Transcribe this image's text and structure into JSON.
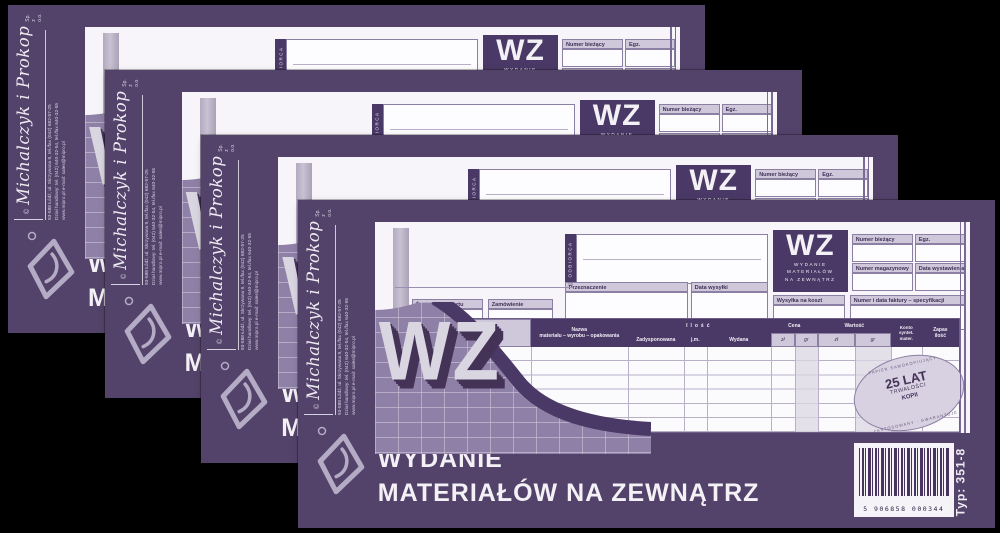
{
  "canvas": {
    "background": "#000000"
  },
  "copies": 4,
  "colors": {
    "purple": "#53426a",
    "purple_dark": "#4a3866",
    "strip_light": "#cfc8da",
    "paper": "#f7f5f9",
    "checker": "#8e80a7",
    "stamp_fill": "#d7d1e1"
  },
  "form": {
    "sidebar": {
      "copyright": "©",
      "company": "Michalczyk i Prokop",
      "suffix": "Sp. z o.o.",
      "address_lines": [
        "93-588 Łódź, ul. Skrzywana 9, tel./fax (042) 682-57-25",
        "Dział handlowy: tel. (042) 640-32-54, tel./fax 640-32-55",
        "www.mipro.pl   e-mail: sales@mipro.pl"
      ]
    },
    "header": {
      "odbiorca": "ODBIORCA",
      "wz": "WZ",
      "wz_sub": [
        "WYDANIE",
        "MATERIAŁÓW",
        "NA ZEWNĄTRZ"
      ],
      "numer_biezacy": "Numer bieżący",
      "egz": "Egz.",
      "numer_magazynowy": "Numer magazynowy",
      "data_wystawienia": "Data wystawienia",
      "wysylka_na_koszt": "Wysyłka na koszt",
      "numer_faktury": "Numer i data faktury – specyfikacji",
      "przeznaczenie": "Przeznaczenie",
      "data_wysylki": "Data wysyłki",
      "srodek_transportu": "Środek transportu",
      "zamowienie": "Zamówienie",
      "year_hint": "19"
    },
    "table": {
      "kod": [
        "Kod",
        "mater."
      ],
      "nazwa": [
        "Nazwa",
        "materiału – wyrobu – opakowania"
      ],
      "ilosc": "Ilość",
      "zadysponowana": "Zadysponowana",
      "jm": "j.m.",
      "wydana": "Wydana",
      "cena": "Cena",
      "wartosc": "Wartość",
      "zl": "zł",
      "gr": "gr",
      "konto": [
        "Konto",
        "syntet.",
        "mater."
      ],
      "zapas": [
        "Zapas",
        "ilość"
      ],
      "body_rows": 6
    },
    "stamp": {
      "ring_top": "PAPIER SAMOKOPIUJĄCY",
      "ring_bottom": "ZASTOSOWANY · GWARANTUJE",
      "line1": "25 LAT",
      "line2": "TRWAŁOŚCI",
      "line3": "KOPII"
    },
    "footer": {
      "wz_big": "WZ",
      "title_line1": "WYDANIE",
      "title_line2": "MATERIAŁÓW NA ZEWNĄTRZ",
      "barcode_digits": "5 906858 000344",
      "print_type_small": "DRUKI SAMOKOPIUJĄCE",
      "print_type": "Typ: 351-8"
    }
  }
}
